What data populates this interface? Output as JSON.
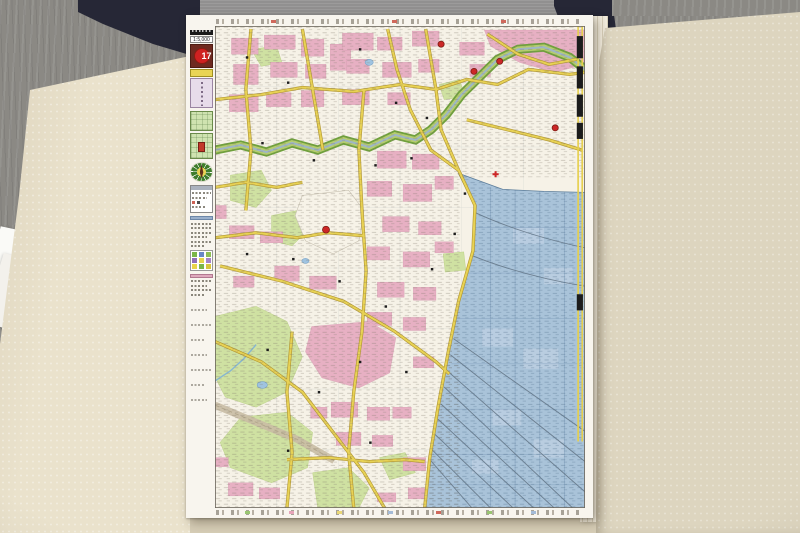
{
  "atlas": {
    "page_number": "17",
    "scale": "1:5,000"
  },
  "map": {
    "type": "city-street-atlas-page",
    "features": {
      "river": "green-banded river crossing upper map toward northeast corner",
      "harbor_district": "blue-tinted harbor and freight district along right edge",
      "railway_yard": "fanned rail sidings in lower right",
      "parks": "light green park areas in lower left",
      "urban_blocks": "pink commercial blocks",
      "roads": "yellow road network"
    },
    "symbols": {
      "landmark": "red-dot",
      "hospital": "red-cross",
      "public_building": "black-square"
    }
  },
  "palette": {
    "urban_pink": "#e7b0c3",
    "road_yellow": "#e8d254",
    "park_green": "#cfe1a2",
    "river_green": "#6fa03c",
    "harbor_blue": "#a9c3d9",
    "pond_blue": "#9fc3e0",
    "landmark_red": "#cc2727",
    "badge_red": "#cf2121",
    "plate_maroon": "#6e2a20",
    "index_marker_red": "#c23a2a",
    "tab_black": "#1c1c1c",
    "paper_white": "#f8f5ee",
    "case_navy": "#262736",
    "case_grey": "#919090",
    "flap_cream": "#eae2cc",
    "flap_cream_dark": "#ddd5bf",
    "floor_grey": "#8b8984"
  }
}
